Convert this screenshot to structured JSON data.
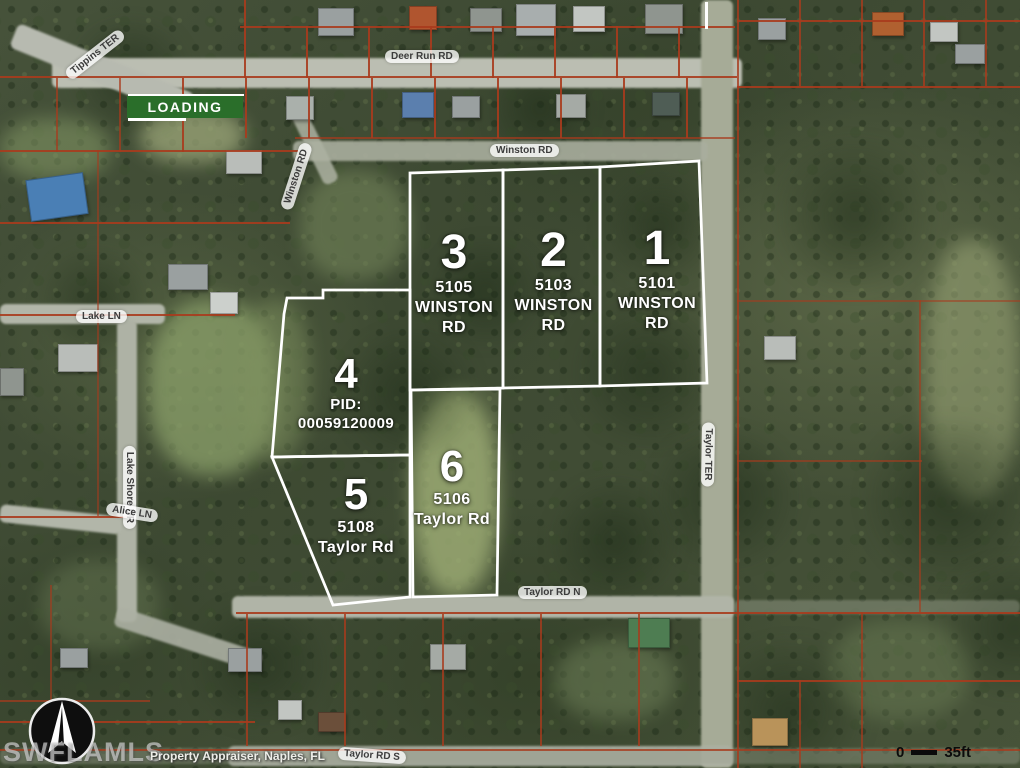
{
  "map": {
    "badge": {
      "label": "LOADING"
    },
    "watermark": "SWFLAMLS",
    "attribution": "Property Appraiser, Naples, FL",
    "scale_bar": {
      "start": "0",
      "end": "35ft"
    },
    "icons": {
      "compass": "compass-north-arrow"
    },
    "colors": {
      "parcel_outline": "#ffffff",
      "boundary_lines": "#a83b1d",
      "badge_green": "#2a6e2a"
    },
    "parcels": [
      {
        "number": "1",
        "address_line1": "5101",
        "address_line2": "WINSTON RD"
      },
      {
        "number": "2",
        "address_line1": "5103",
        "address_line2": "WINSTON RD"
      },
      {
        "number": "3",
        "address_line1": "5105",
        "address_line2": "WINSTON RD"
      },
      {
        "number": "4",
        "address_line1": "PID: 00059120009",
        "address_line2": ""
      },
      {
        "number": "5",
        "address_line1": "5108",
        "address_line2": "Taylor Rd"
      },
      {
        "number": "6",
        "address_line1": "5106",
        "address_line2": "Taylor Rd"
      }
    ],
    "street_labels": [
      {
        "text": "Tippins TER"
      },
      {
        "text": "Deer Run RD"
      },
      {
        "text": "Winston RD"
      },
      {
        "text": "Winston RD"
      },
      {
        "text": "Lake LN"
      },
      {
        "text": "Lake Shore DR"
      },
      {
        "text": "Alice LN"
      },
      {
        "text": "Taylor TER"
      },
      {
        "text": "Taylor RD N"
      },
      {
        "text": "Taylor RD S"
      }
    ]
  }
}
